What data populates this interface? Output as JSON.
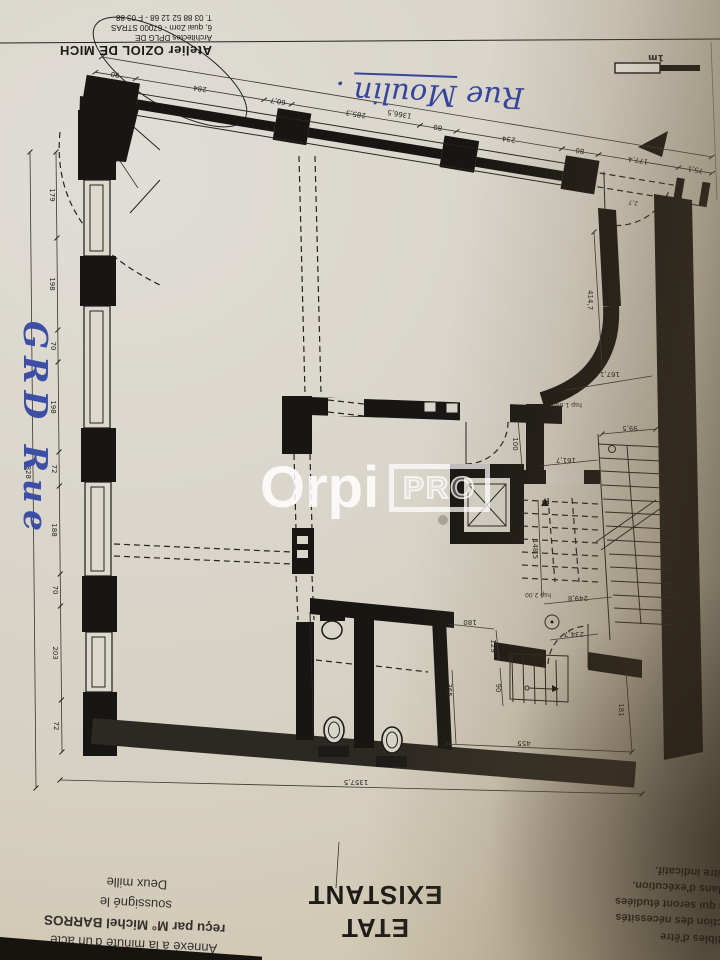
{
  "document": {
    "paper_color": "#d9d5cb",
    "ink_color": "#1c1c1c",
    "accent_blue": "#3a4aa0",
    "shadow_color": "#4a4136",
    "watermark_color": "#ffffff"
  },
  "architect_block": {
    "line1": "Atelier OZIOL DE MICH",
    "line2": "Architectes DPLG DE",
    "line3": "6, quai Zorn - 67000 STRAS",
    "line4": "T. 03 88 52 12 68 - F 03 88"
  },
  "handwriting": {
    "street_top_word1": "Rue",
    "street_top_word2": "Moulin",
    "street_top_punct": ".",
    "street_left": "GRD Rue"
  },
  "scale_bar": {
    "label": "1m"
  },
  "watermark": {
    "brand": "Orpi",
    "badge": "PRO"
  },
  "plan_title": {
    "line1": "ETAT",
    "line2": "EXISTANT"
  },
  "notary_stamp": {
    "line1": "Annexé à la minute d'un acte",
    "line2": "reçu par M° Michel BARROS",
    "line3": "soussigné le",
    "line4": "Deux mille"
  },
  "disclaimer": {
    "heading": "on contractuel:",
    "line1": "ons sont susceptibles d'être",
    "line2": "ces plans en fonction des nécessités",
    "line3": "et réglementaires qui seront étudiées",
    "line4": "se au point des plans d'exécution.",
    "line5": "est représenté à titre indicatif."
  },
  "dims": {
    "w90": "90",
    "w284": "284",
    "w60_7": "60,7",
    "w285_3": "285,3",
    "w80a": "80",
    "w234": "234",
    "w80b": "80",
    "w177_4": "177,4",
    "w75_1": "75,1",
    "w1366_5": "1366,5",
    "door": "2,7",
    "diag": "129,4",
    "l179": "179",
    "l198a": "198",
    "l70a": "70",
    "l198b": "198",
    "l72a": "72",
    "l188": "188",
    "l70b": "70",
    "l203": "203",
    "l72b": "72",
    "l1828": "1828",
    "r414_7": "414,7",
    "r167_1": "167,1",
    "r25": "25",
    "r100": "100",
    "r99_5": "99,5",
    "r161_7": "161,7",
    "r148_5": "148,5",
    "r249_8": "249,8",
    "r234_7": "234,7",
    "hsp_a": "hsp 1.66m",
    "hsp_b": "hsp 2.00",
    "b180": "180",
    "b129": "129",
    "b365": "365",
    "b90": "90",
    "b455": "455",
    "b181": "181",
    "b1357_5": "1357,5"
  }
}
